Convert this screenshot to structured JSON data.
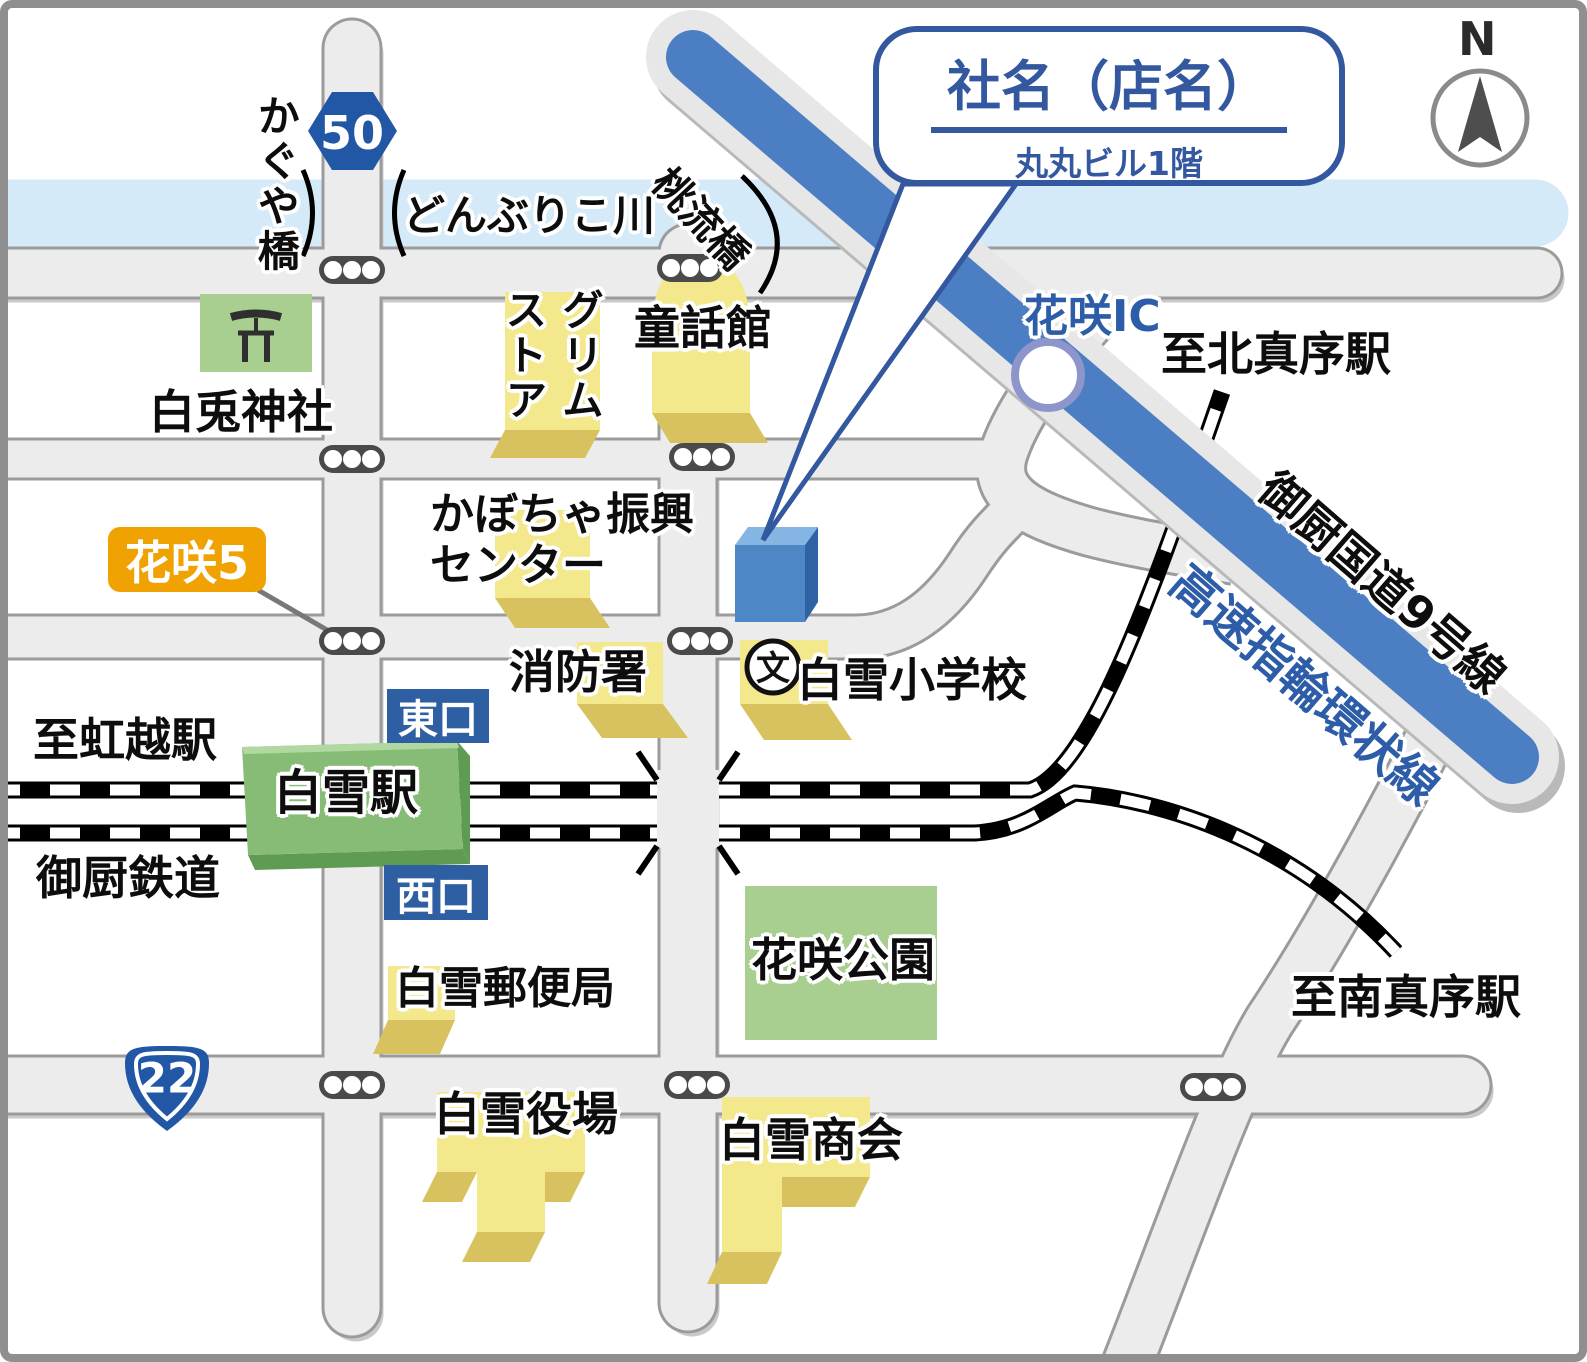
{
  "callout": {
    "title": "社名（店名）",
    "subtitle": "丸丸ビル1階"
  },
  "compass": {
    "label": "N"
  },
  "water": {
    "river_name": "どんぶりこ川"
  },
  "bridges": {
    "kaguya": "かぐや橋",
    "momonagare": "桃流橋"
  },
  "route_shields": {
    "hexagon_route": "50",
    "triangle_route": "22"
  },
  "highway": {
    "expressway_name": "高速指輪環状線",
    "national_road_name": "御厨国道9号線",
    "interchange": "花咲IC"
  },
  "railway": {
    "company": "御厨鉄道",
    "to_west": "至虹越駅",
    "to_north": "至北真序駅",
    "to_south": "至南真序駅"
  },
  "station": {
    "name": "白雪駅",
    "east_exit": "東口",
    "west_exit": "西口"
  },
  "intersections": {
    "hanasaki5": "花咲5"
  },
  "places": {
    "shrine": "白兎神社",
    "grimm_store": "グリム\nストア",
    "fairy_tale_hall": "童話館",
    "pumpkin_center": "かぼちゃ振興\nセンター",
    "fire_station": "消防署",
    "elementary_school": "白雪小学校",
    "school_symbol": "文",
    "post_office": "白雪郵便局",
    "park": "花咲公園",
    "town_hall": "白雪役場",
    "shokai": "白雪商会"
  },
  "colors": {
    "accent_blue": "#2d5da8",
    "highway_blue": "#4b7ec2",
    "river_blue": "#d5eaf8",
    "road_fill": "#ececec",
    "road_edge": "#9b9b9b",
    "building_yellow": "#f4e88d",
    "building_yellow_side": "#d8c25f",
    "area_green": "#a8cf8f",
    "station_green": "#87bc77",
    "badge_orange": "#f0a202",
    "target_blue": "#4e87c6"
  }
}
